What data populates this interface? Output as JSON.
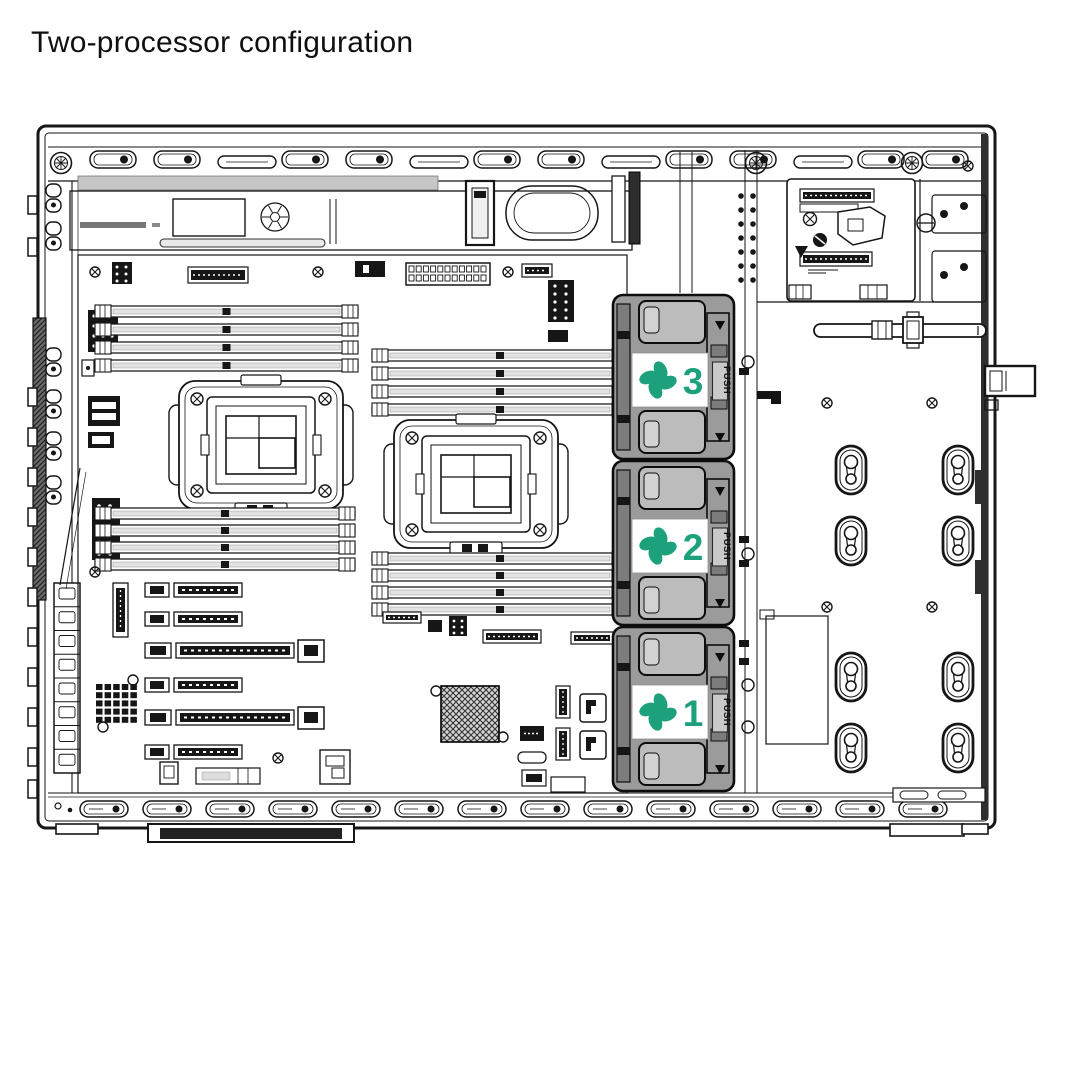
{
  "title": "Two-processor configuration",
  "diagram": {
    "fans": [
      {
        "number": "3",
        "push_label": "PUSH"
      },
      {
        "number": "2",
        "push_label": "PUSH"
      },
      {
        "number": "1",
        "push_label": "PUSH"
      }
    ],
    "colors": {
      "fan_accent": "#1CA17C",
      "fan_body": "#9b9b9b",
      "line": "#161616"
    }
  }
}
